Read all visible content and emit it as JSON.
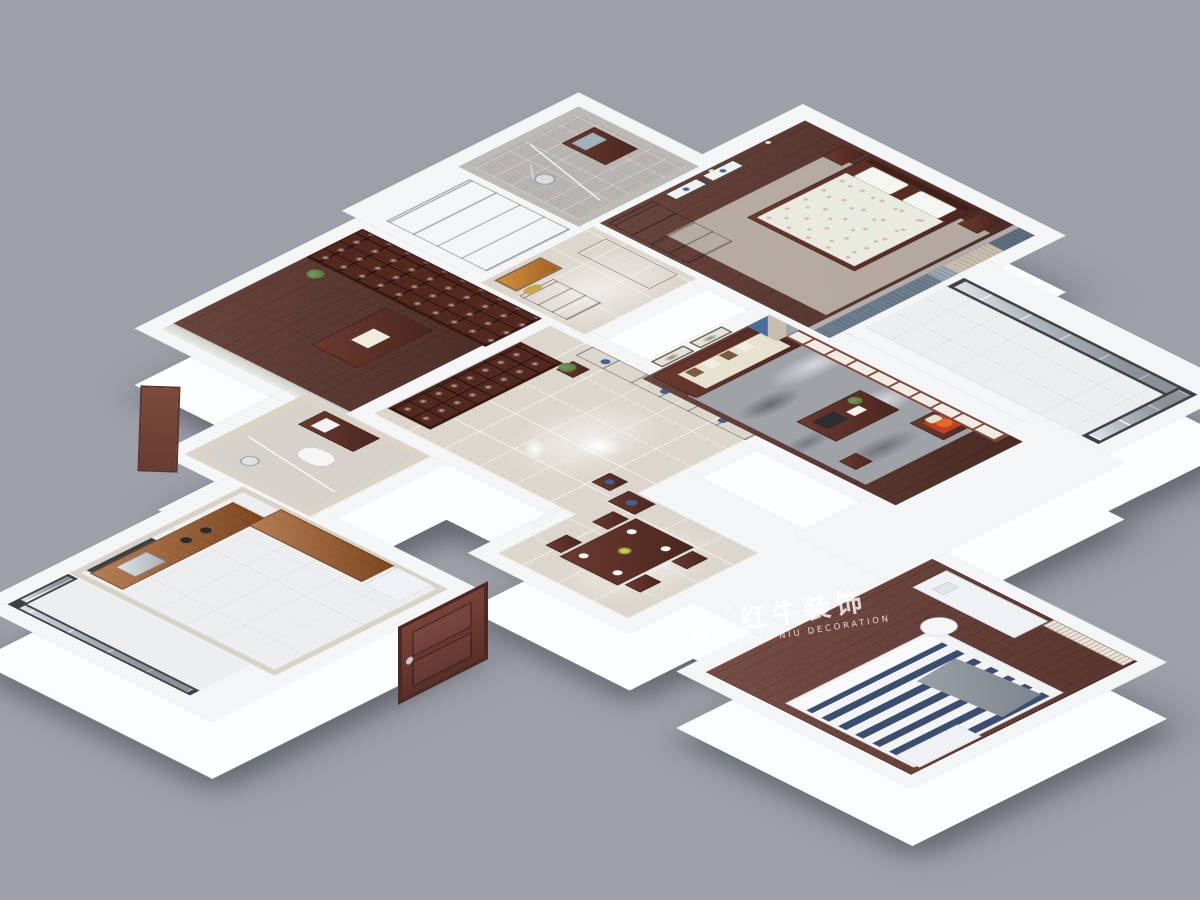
{
  "watermark": {
    "registered_mark": "®",
    "brand_zh": "红牛装饰",
    "brand_en": "HONG NIU DECORATION"
  },
  "palette": {
    "bg": "#9da0a9",
    "wall_top": "#f4f5f7",
    "wall_face": "#fcfdfe",
    "wood_dark": "#5c362e",
    "wood_red": "#6b4038",
    "tile_beige": "#dcd6cc",
    "tile_gray": "#b7b4b0",
    "tile_white": "#eceef0",
    "counter_wood": "#a05a28",
    "marble_rug": "#9fa2a7",
    "glass": "#b2b8c1",
    "frame_dark": "#3d4147",
    "curtain_bluegray": "#6e7d8c",
    "curtain_tan": "#c8beb0",
    "cushion_cream": "#e7e1cf",
    "cushion_red": "#c2401f",
    "porcelain_blue": "#3f5f95",
    "stripe_navy": "#3d4d6f",
    "blinds_tan": "#cfc4b4",
    "art_orange": "#a45f1d",
    "plant_green": "#4c6b38",
    "watermark": "rgba(255,255,255,0.80)"
  }
}
